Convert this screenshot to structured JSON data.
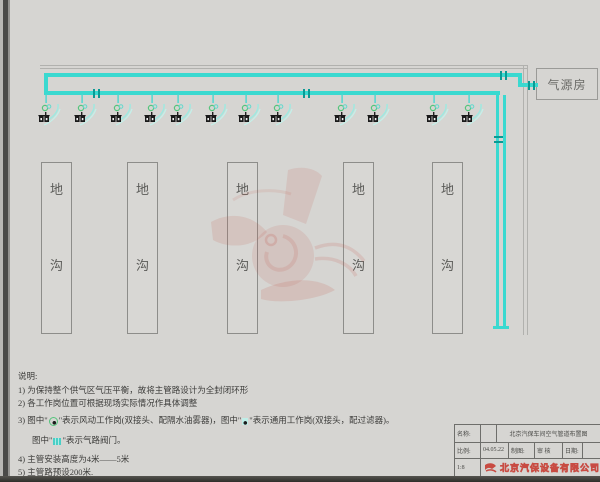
{
  "page": {
    "background": "#d6d5d2"
  },
  "drawing": {
    "air_source_room": {
      "label": "气源房"
    },
    "trench": {
      "count": 5,
      "label_top": "地",
      "label_bottom": "沟"
    },
    "workstations": {
      "count": 12
    },
    "pipe_color": "#3ad9d0",
    "workstation_green": "#55c47c",
    "watermark_red": "#c4574d"
  },
  "notes": {
    "title": "说明:",
    "line1": "1) 为保持整个供气区气压平衡，故将主管路设计为全封闭环形",
    "line2": "2) 各工作岗位置可根据现场实际情况作具体调整",
    "line3_a": "3) 图中\"",
    "line3_b": "\"表示风动工作岗(双接头、配隔水油雾器)，图中\"",
    "line3_c": "\"表示通用工作岗(双接头，配过滤器)。",
    "line4_a": "图中\"",
    "line4_b": "\"表示气路阀门。",
    "line5": "4) 主管安装高度为4米——5米",
    "line6": "5) 主管路预设200米."
  },
  "title_block": {
    "name_label": "名称:",
    "drawing_title": "北京汽保车间空气管道布置图",
    "scale_label": "比例:",
    "date_value": "04.05.22",
    "draft_label": "制图:",
    "review_label": "审 核",
    "date_label": "日期:",
    "scale_value": "1:8",
    "company": "北京汽保设备有限公司"
  }
}
